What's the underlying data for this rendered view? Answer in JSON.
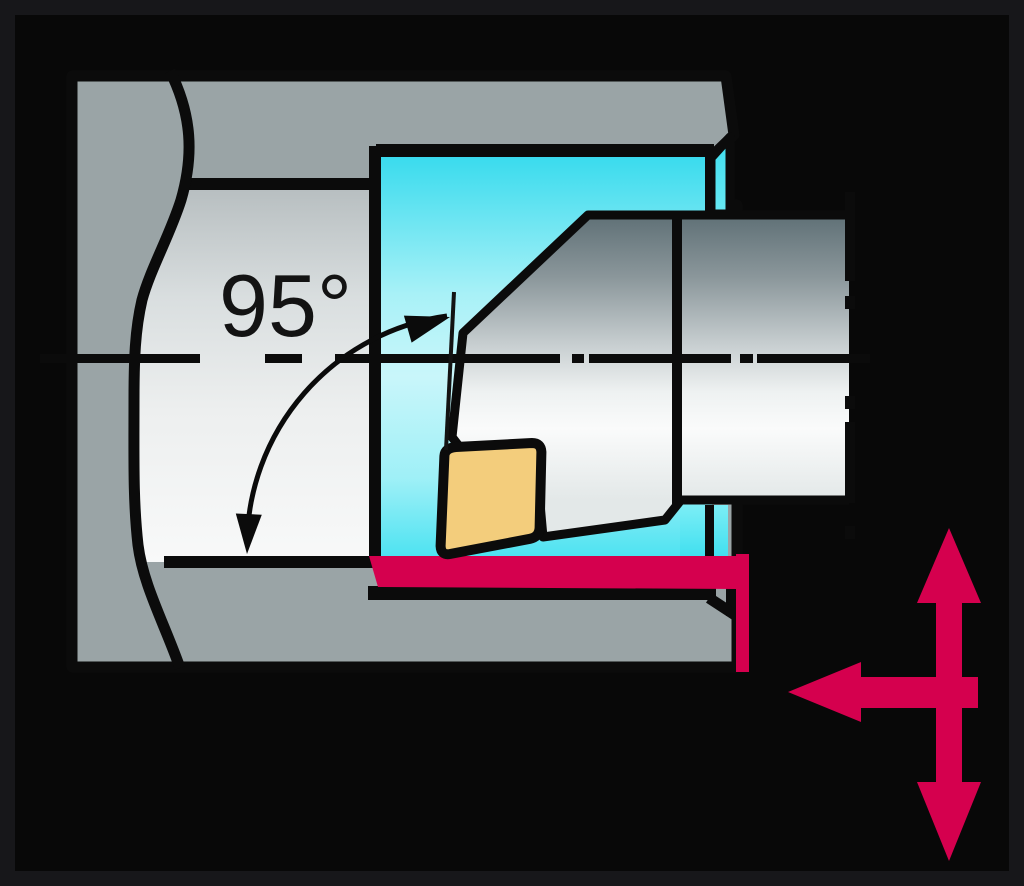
{
  "illustration": {
    "annotations": {
      "entering_angle_label": "95°"
    },
    "icons": {
      "axial_feed_arrow": "left-arrow",
      "radial_feed_arrow": "up-down-double-arrow",
      "angle_arc": "arc-with-arrowheads",
      "centerline": "dash-dot-line"
    },
    "colors": {
      "frame": "#17171a",
      "background": "#080808",
      "outline_black": "#0b0b0b",
      "workpiece_gray": "#9aa4a6",
      "bore_cyan_dark": "#35daed",
      "bore_cyan_light": "#c9f6fa",
      "tool_steel_dark": "#5f7076",
      "tool_steel_light": "#fafbfb",
      "insert_yellow": "#f3cd7c",
      "feed_red": "#d5004e"
    }
  }
}
